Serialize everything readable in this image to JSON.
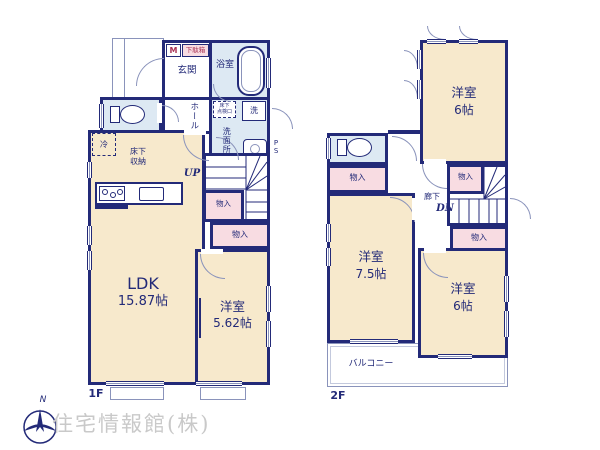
{
  "colors": {
    "wall": "#232a78",
    "room_cream": "#f7e9cc",
    "wet_blue": "#dde9f3",
    "closet_pink": "#f8dce2",
    "accent_red": "#a93355",
    "thin_line": "#8a93bb",
    "watermark_gray": "#c9c9c9"
  },
  "floor1": {
    "floor_label": "1F",
    "labels": {
      "genkan": "玄関",
      "bath": "浴室",
      "hall": "ホール",
      "washroom": "洗面所",
      "washer": "洗",
      "inspection_l1": "床下",
      "inspection_l2": "点検口",
      "meter": "M",
      "shoebox": "下駄箱",
      "fridge": "冷",
      "underfloor_l1": "床下",
      "underfloor_l2": "収納",
      "up": "UP",
      "closet_a": "物入",
      "closet_b": "物入",
      "ldk_name": "LDK",
      "ldk_size": "15.87帖",
      "bedroom_name": "洋室",
      "bedroom_size": "5.62帖",
      "ps": "PS"
    }
  },
  "floor2": {
    "floor_label": "2F",
    "labels": {
      "bedroom_top_name": "洋室",
      "bedroom_top_size": "6帖",
      "closet_left": "物入",
      "closet_mid": "物入",
      "closet_right": "物入",
      "hallway": "廊下",
      "dn": "DN",
      "bedroom_left_name": "洋室",
      "bedroom_left_size": "7.5帖",
      "bedroom_right_name": "洋室",
      "bedroom_right_size": "6帖",
      "balcony": "バルコニー"
    }
  },
  "footer": {
    "company": "住宅情報館(株)",
    "compass_n": "N"
  }
}
